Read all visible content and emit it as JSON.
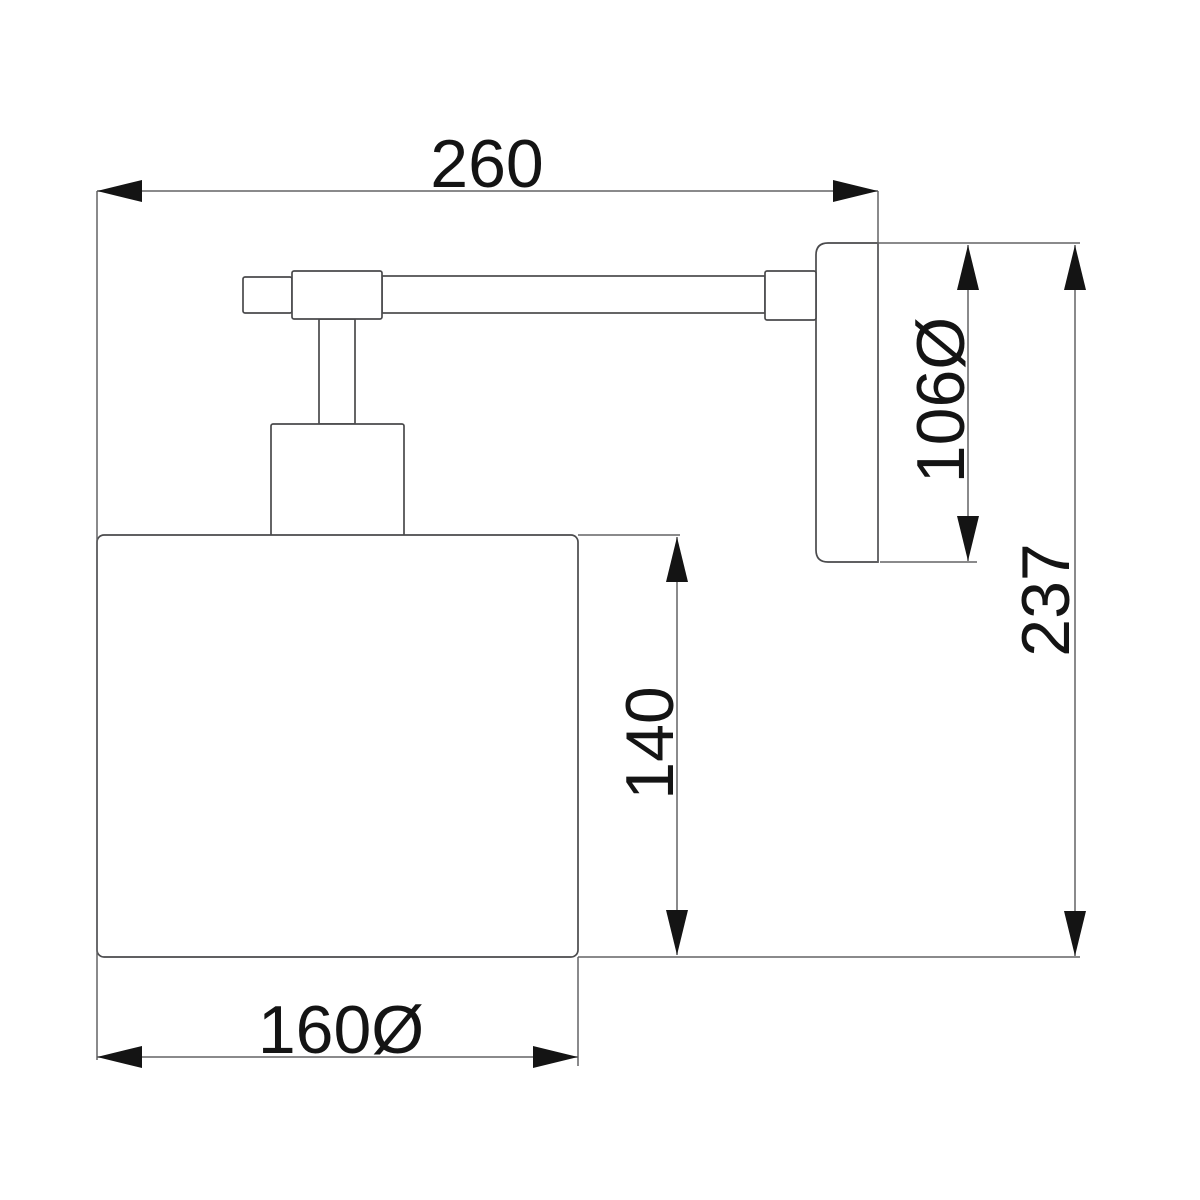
{
  "drawing": {
    "type": "technical-dimension-drawing",
    "subject": "wall-mounted lamp, side elevation",
    "labels": {
      "arm_projection": "260",
      "backplate_diameter": "106Ø",
      "overall_height": "237",
      "shade_height": "140",
      "shade_diameter": "160Ø"
    },
    "values": {
      "arm_projection": 260,
      "backplate_diameter": 106,
      "overall_height": 237,
      "shade_height": 140,
      "shade_diameter": 160
    }
  },
  "colors": {
    "background": "#ffffff",
    "line": "#636365",
    "object-line": "#4a4a4c",
    "ink": "#141414"
  }
}
